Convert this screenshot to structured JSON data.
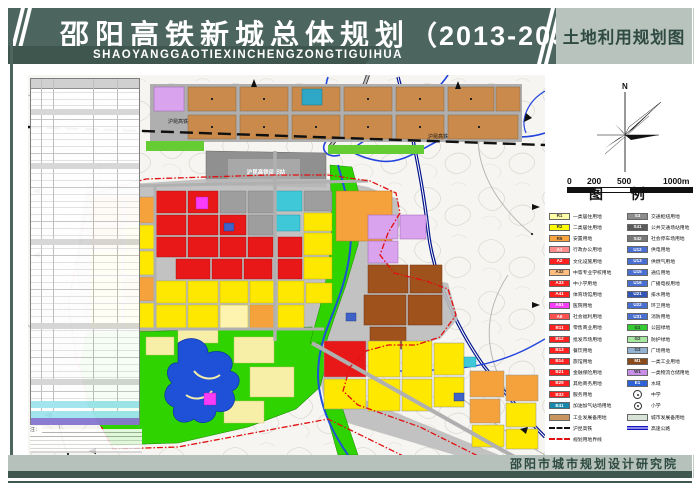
{
  "header": {
    "title": "邵阳高铁新城总体规划",
    "title_years": "（2013-2030）",
    "pinyin": "SHAOYANGGAOTIEXINCHENGZONGTIGUIHUA",
    "right_title": "土地利用规划图"
  },
  "footer": {
    "institute": "邵阳市城市规划设计研究院"
  },
  "compass": {
    "label": "N"
  },
  "scalebar": {
    "labels": [
      "0",
      "200",
      "500",
      "1000m"
    ]
  },
  "map": {
    "railway_label": "沪昆高铁",
    "station_label": "沪昆高铁邵阳站",
    "note_prefix": "注："
  },
  "legend": {
    "title": "图  例",
    "left": [
      {
        "code": "R1",
        "label": "一类居住用地",
        "color": "#ffffa8",
        "tc": "#333333"
      },
      {
        "code": "R2",
        "label": "二类居住用地",
        "color": "#ffff00",
        "tc": "#333333"
      },
      {
        "code": "R5",
        "label": "安置用地",
        "color": "#fba33c",
        "tc": "#333333"
      },
      {
        "code": "A1",
        "label": "行政办公用地",
        "color": "#ff8a8a",
        "tc": "#ffffff"
      },
      {
        "code": "A2",
        "label": "文化设施用地",
        "color": "#ff2020",
        "tc": "#ffffff"
      },
      {
        "code": "A32",
        "label": "中等专业学校用地",
        "color": "#ffbe7d",
        "tc": "#333333"
      },
      {
        "code": "A33",
        "label": "中小学用地",
        "color": "#ff2020",
        "tc": "#ffffff"
      },
      {
        "code": "A41",
        "label": "体育场馆用地",
        "color": "#ff2020",
        "tc": "#ffffff"
      },
      {
        "code": "A51",
        "label": "医院用地",
        "color": "#f93cf9",
        "tc": "#ffffff"
      },
      {
        "code": "A6",
        "label": "社会福利用地",
        "color": "#ff5050",
        "tc": "#ffffff"
      },
      {
        "code": "B11",
        "label": "零售商业用地",
        "color": "#ff2020",
        "tc": "#ffffff"
      },
      {
        "code": "B12",
        "label": "批发市场用地",
        "color": "#ff2020",
        "tc": "#ffffff"
      },
      {
        "code": "B13",
        "label": "餐饮用地",
        "color": "#ff2020",
        "tc": "#ffffff"
      },
      {
        "code": "B14",
        "label": "旅馆用地",
        "color": "#ff2020",
        "tc": "#ffffff"
      },
      {
        "code": "B21",
        "label": "金融保险用地",
        "color": "#ff2020",
        "tc": "#ffffff"
      },
      {
        "code": "B29",
        "label": "其他商务用地",
        "color": "#ff2020",
        "tc": "#ffffff"
      },
      {
        "code": "B32",
        "label": "服务用地",
        "color": "#ff2020",
        "tc": "#ffffff"
      },
      {
        "code": "B41",
        "label": "加油加气站场用地",
        "color": "#1787ac",
        "tc": "#ffffff"
      },
      {
        "code": "",
        "label": "工业发展备用地",
        "color": "#c8955f",
        "tc": "#333333"
      },
      {
        "type": "rail",
        "label": "沪昆高铁"
      },
      {
        "type": "boundary",
        "label": "规划用地界线"
      }
    ],
    "right": [
      {
        "code": "S3",
        "label": "交通枢纽用地",
        "color": "#8c8c8c",
        "tc": "#ffffff"
      },
      {
        "code": "S41",
        "label": "公共交通场站用地",
        "color": "#5a5a5a",
        "tc": "#ffffff"
      },
      {
        "code": "S42",
        "label": "社会停车场用地",
        "color": "#787878",
        "tc": "#ffffff"
      },
      {
        "code": "U12",
        "label": "供电用地",
        "color": "#4a6fd2",
        "tc": "#ffffff"
      },
      {
        "code": "U13",
        "label": "供燃气用地",
        "color": "#4a6fd2",
        "tc": "#ffffff"
      },
      {
        "code": "U15",
        "label": "通信用地",
        "color": "#4a6fd2",
        "tc": "#ffffff"
      },
      {
        "code": "U16",
        "label": "广播电视用地",
        "color": "#4a6fd2",
        "tc": "#ffffff"
      },
      {
        "code": "U21",
        "label": "排水用地",
        "color": "#3355b8",
        "tc": "#ffffff"
      },
      {
        "code": "U22",
        "label": "环卫用地",
        "color": "#4a6fd2",
        "tc": "#ffffff"
      },
      {
        "code": "U31",
        "label": "消防用地",
        "color": "#4a6fd2",
        "tc": "#ffffff"
      },
      {
        "code": "G1",
        "label": "公园绿地",
        "color": "#33cc33",
        "tc": "#333333"
      },
      {
        "code": "G2",
        "label": "防护绿地",
        "color": "#a6e8a0",
        "tc": "#333333"
      },
      {
        "code": "G3",
        "label": "广场用地",
        "color": "#92b4d2",
        "tc": "#333333"
      },
      {
        "code": "M1",
        "label": "一类工业用地",
        "color": "#8a4a1a",
        "tc": "#ffffff"
      },
      {
        "code": "W1",
        "label": "一类物流仓储用地",
        "color": "#c98fe8",
        "tc": "#333333"
      },
      {
        "code": "E1",
        "label": "水域",
        "color": "#2e62d9",
        "tc": "#ffffff"
      },
      {
        "type": "school-mid",
        "label": "中学"
      },
      {
        "type": "school-pri",
        "label": "小学"
      },
      {
        "code": "",
        "label": "城市发展备用地",
        "color": "#d7e3d7",
        "tc": "#333333"
      },
      {
        "type": "highway",
        "label": "高速公路"
      }
    ]
  },
  "colors": {
    "header_bg": "#4c655e",
    "header_light": "#b7c3bc",
    "header_text": "#ffffff",
    "accent_teal": "#3e5850",
    "boundary_red": "#e01010",
    "water_blue": "#1e50d8",
    "park_green": "#2fd400",
    "residential_yellow": "#ffe800",
    "commercial_red": "#e81818",
    "industry_reserve_brown": "#c98a4b",
    "industry_dark_brown": "#a0521d"
  }
}
